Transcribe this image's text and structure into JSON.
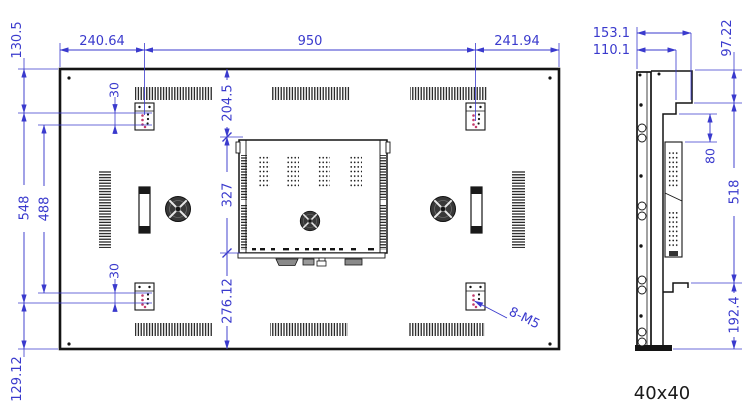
{
  "drawing_title": "display-mount-dimension-drawing",
  "colors": {
    "dimension_blue": "#3a3acd",
    "line_black": "#141414",
    "hole_accent_red": "#c23a6b"
  },
  "rear_view": {
    "dim_top_left": "240.64",
    "dim_top_center": "950",
    "dim_top_right": "241.94",
    "dim_left_top": "130.5",
    "dim_left_outer": "548",
    "dim_left_inner": "488",
    "dim_left_bottom": "129.12",
    "dim_hole_gap_top": "30",
    "dim_hole_gap_bottom": "30",
    "dim_center_top": "204.5",
    "dim_center_box": "327",
    "dim_center_bottom": "276.12",
    "thread_callout": "8-M5"
  },
  "side_view": {
    "dim_depth_outer": "153.1",
    "dim_depth_inner": "110.1",
    "dim_top": "97.22",
    "dim_hook": "80",
    "dim_middle": "518",
    "dim_bottom": "192.4",
    "profile_label": "40x40"
  }
}
